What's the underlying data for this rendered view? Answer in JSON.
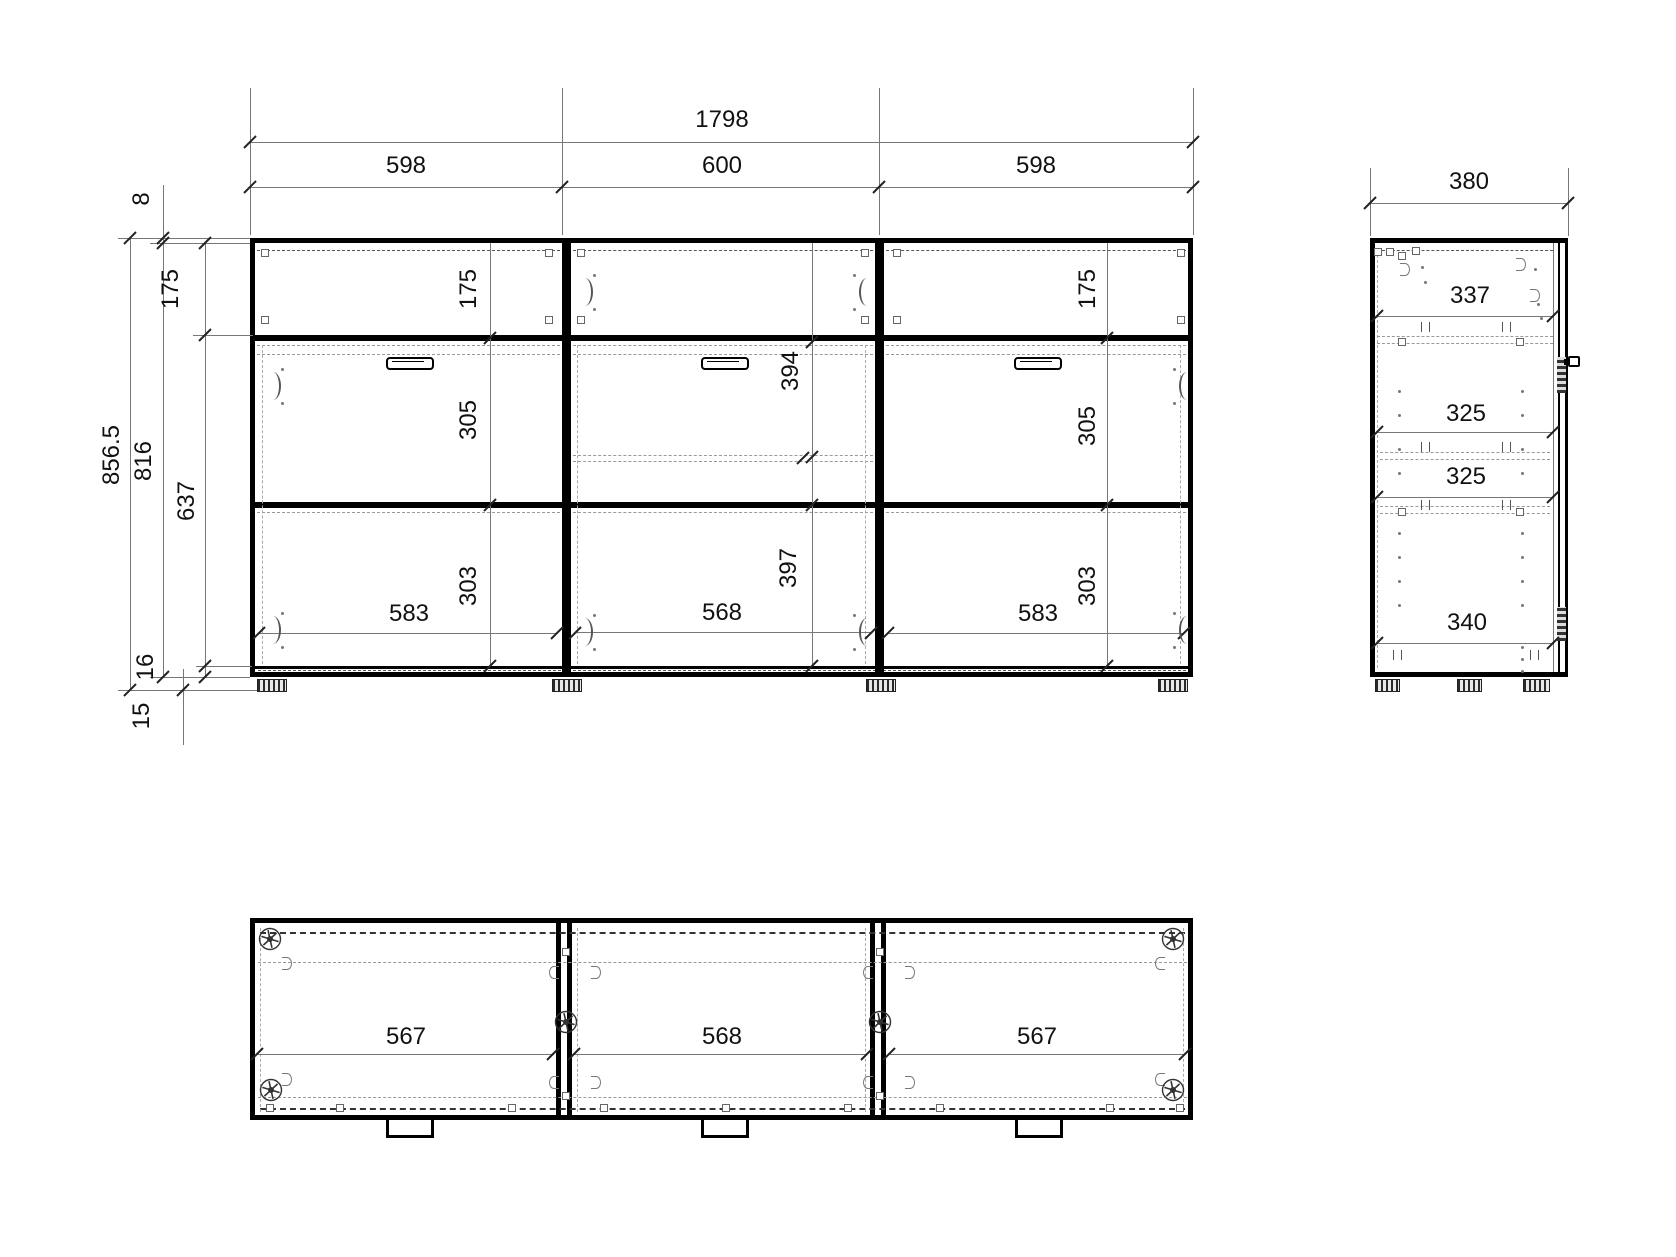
{
  "colors": {
    "line": "#000000",
    "dim_line": "#777777",
    "text": "#111111",
    "background": "#ffffff"
  },
  "front_view": {
    "dim_total_width": "1798",
    "dim_col_widths": [
      "598",
      "600",
      "598"
    ],
    "dim_left": {
      "top_offset": "8",
      "overall_height": "856.5",
      "body_height": "816",
      "lower_height": "637",
      "row1_height": "175",
      "bottom_panel": "16",
      "feet_height": "15"
    },
    "columns": [
      {
        "row1": "175",
        "row2": "305",
        "row3": "303",
        "door_width": "583"
      },
      {
        "row2": "394",
        "row3": "397",
        "door_width": "568"
      },
      {
        "row1": "175",
        "row2": "305",
        "row3": "303",
        "door_width": "583"
      }
    ]
  },
  "side_view": {
    "dim_width": "380",
    "shelf_dims": [
      "337",
      "325",
      "325",
      "340"
    ]
  },
  "bottom_view": {
    "section_widths": [
      "567",
      "568",
      "567"
    ]
  }
}
